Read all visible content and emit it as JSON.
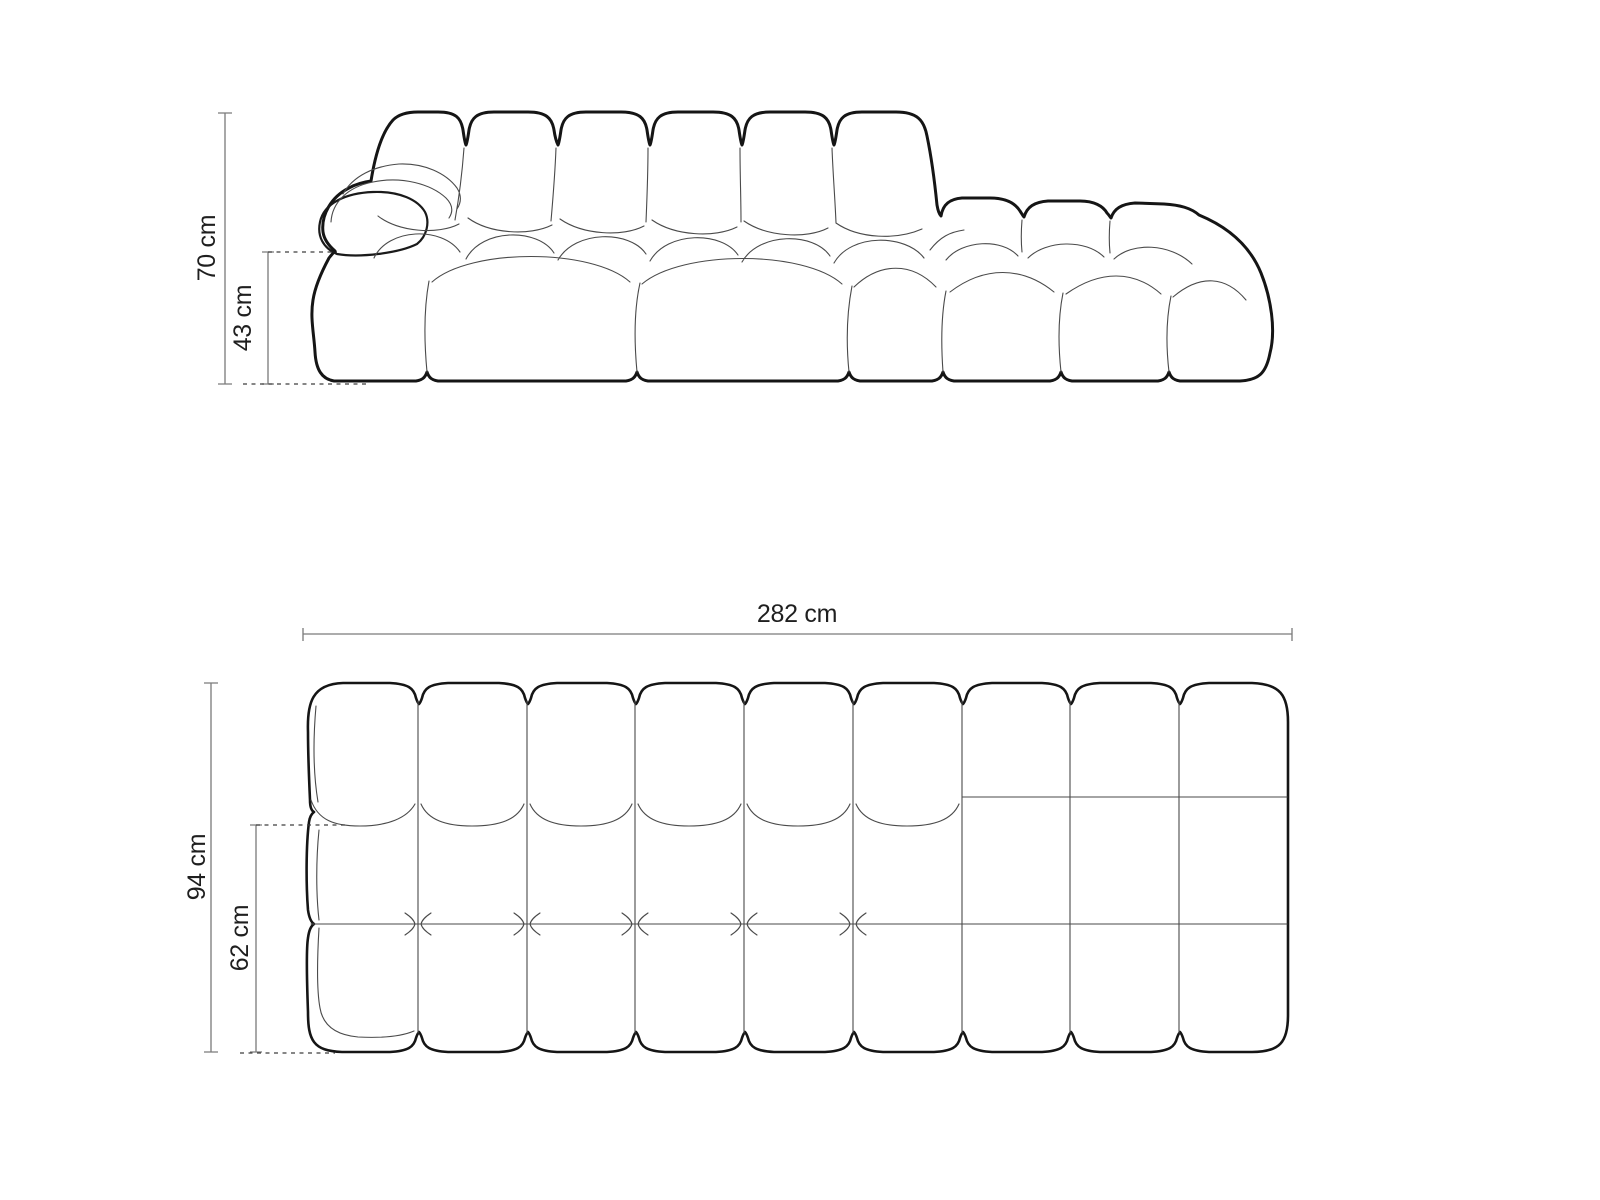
{
  "diagram": {
    "front_view": {
      "height_label": "70 cm",
      "seat_height_label": "43 cm"
    },
    "top_view": {
      "width_label": "282 cm",
      "depth_label": "94 cm",
      "seat_depth_label": "62 cm"
    },
    "colors": {
      "background": "#ffffff",
      "outline": "#151515",
      "seam": "#4a4a4a",
      "dimension_line": "#7a7a7a",
      "dashed_line": "#3f3f3f",
      "label_text": "#1f1f1f"
    }
  }
}
